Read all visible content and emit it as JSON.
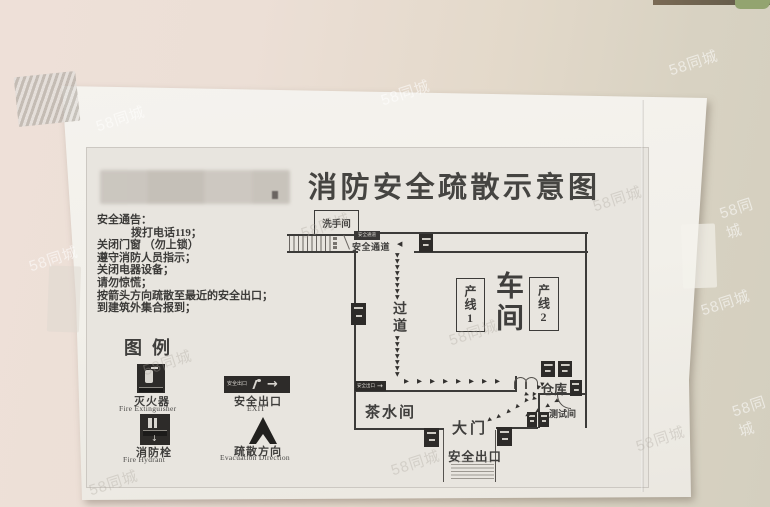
{
  "watermark_text": "58同城",
  "title": "消防安全疏散示意图",
  "notice": {
    "heading": "安全通告：",
    "lines": [
      "拨打电话119；",
      "关闭门窗 （勿上锁）",
      "遵守消防人员指示；",
      "关闭电器设备；",
      "请勿惊慌；",
      "按箭头方向疏散至最近的安全出口；",
      "到建筑外集合报到；"
    ]
  },
  "legend": {
    "heading": "图例",
    "items": [
      {
        "cn": "灭火器",
        "en": "Fire Extinguisher"
      },
      {
        "cn": "安全出口",
        "en": "EXIT"
      },
      {
        "cn": "消防栓",
        "en": "Fire Hydrant"
      },
      {
        "cn": "疏散方向",
        "en": "Evacuation Direction"
      }
    ]
  },
  "map": {
    "labels": {
      "washroom": "洗手间",
      "safety_passage": "安全通道",
      "corridor": "过道",
      "workshop": "车间",
      "line1": "产线1",
      "line2": "产线2",
      "warehouse": "仓库",
      "tea_room": "茶水间",
      "main_gate": "大门",
      "test_room": "测试间",
      "safety_exit": "安全出口"
    },
    "signs": {
      "passage_badge": "安全通道",
      "exit_mini": "安全出口"
    },
    "glyphs": {
      "down": "▼",
      "right": "▶",
      "left": "◀",
      "down_arrow": "↓",
      "long_right": "→"
    }
  },
  "colors": {
    "wall_left": "#eee0d8",
    "wall_right": "#d4cfbf",
    "paper": "#f3f1ec",
    "print_area": "#e8e5df",
    "ink": "#3c3b39",
    "top_trim": "#6f5f4c",
    "green_trim": "#93a470"
  }
}
